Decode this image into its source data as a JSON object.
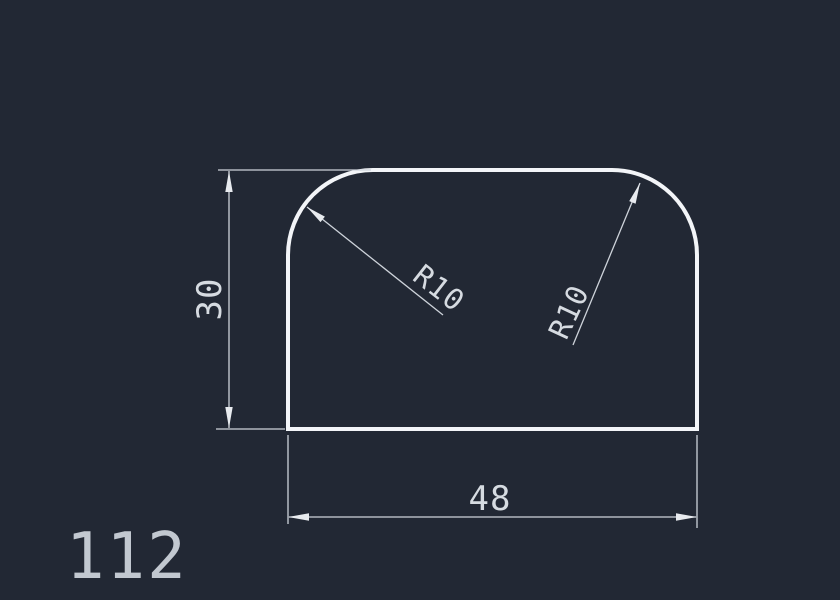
{
  "canvas": {
    "background_color": "#222834",
    "outline_color": "#f3f5f8",
    "dimension_line_color": "#ced3da",
    "dimension_text_color": "#d6dbe1",
    "drawing_number_color": "#c2c8d0"
  },
  "drawing": {
    "number": "112",
    "part": {
      "width_units": 48,
      "height_units": 30,
      "corner_radius_units": 10
    },
    "labels": {
      "height": "30",
      "width": "48",
      "radius_left": "R10",
      "radius_right": "R10"
    }
  }
}
